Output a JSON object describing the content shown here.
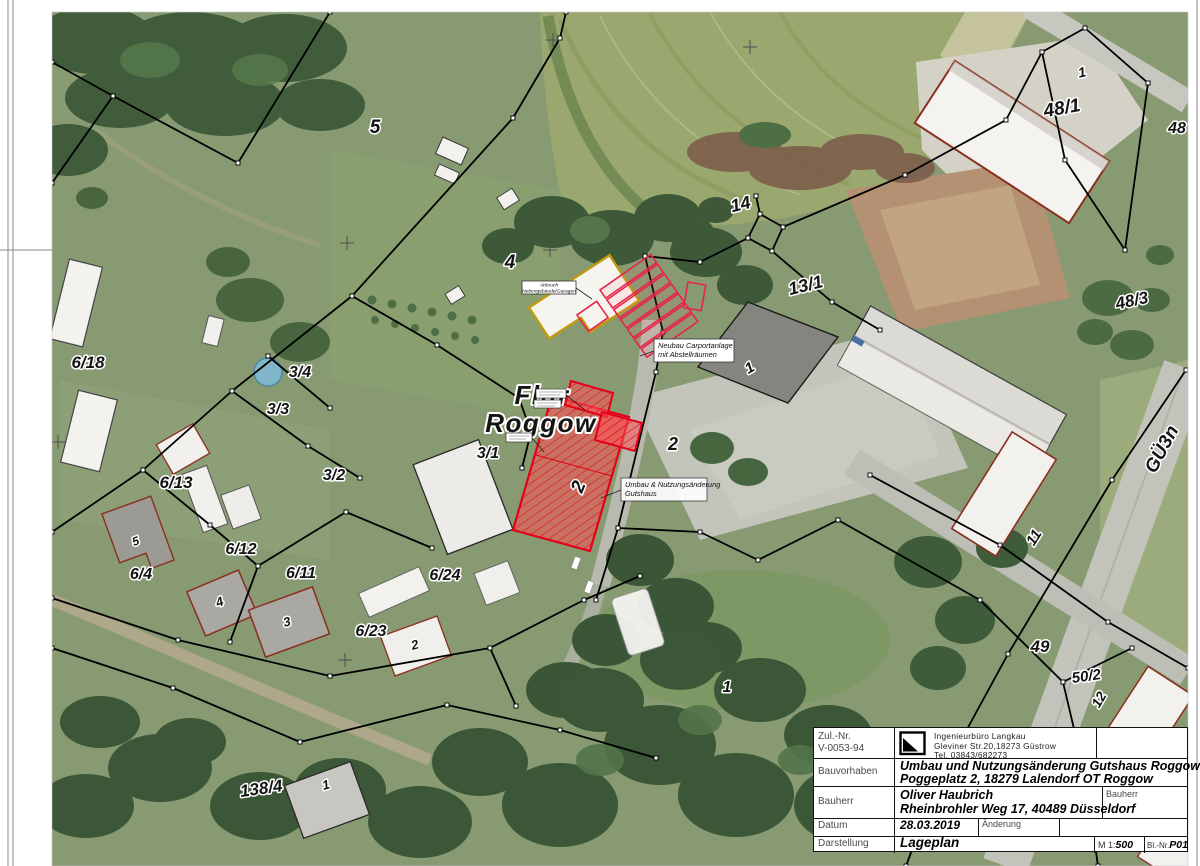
{
  "title_block": {
    "zul_label": "Zul.-Nr.",
    "zul_value": "V-0053-94",
    "company_name": "Ingenieurbüro Langkau",
    "company_street": "Gleviner Str.20,18273 Güstrow",
    "company_tel": "Tel. 03843/682273",
    "bauvorhaben_label": "Bauvorhaben",
    "bauvorhaben_line1": "Umbau und Nutzungsänderung Gutshaus Roggow",
    "bauvorhaben_line2": "Poggeplatz 2, 18279 Lalendorf OT Roggow",
    "bauherr_label": "Bauherr",
    "bauherr_line1": "Oliver Haubrich",
    "bauherr_line2": "Rheinbrohler Weg 17, 40489 Düsseldorf",
    "bauherr_right_label": "Bauherr",
    "datum_label": "Datum",
    "datum_value": "28.03.2019",
    "aenderung_label": "Änderung",
    "darstellung_label": "Darstellung",
    "darstellung_value": "Lageplan",
    "scale_prefix": "M  1:",
    "scale_value": "500",
    "blnr_label": "Bl.-Nr.",
    "blnr_value": "P01"
  },
  "map": {
    "flur_line1": "Flur",
    "flur_line2": "Roggow",
    "road_label": "GÜ3n",
    "annotations": {
      "abbruch_line1": "Abbruch",
      "abbruch_line2": "Nebengebäude/Garagen",
      "carport_line1": "Neubau Carportanlage",
      "carport_line2": "mit Abstellräumen",
      "umbau_line1": "Umbau & Nutzungsänderung",
      "umbau_line2": "Gutshaus"
    },
    "parcels": {
      "f5": "5",
      "f4": "4",
      "f1": "1",
      "p6_18": "6/18",
      "p3_4": "3/4",
      "p3_3": "3/3",
      "p3_2": "3/2",
      "p3_1": "3/1",
      "p6_13": "6/13",
      "p6_4": "6/4",
      "p6_12": "6/12",
      "p6_11": "6/11",
      "p6_23": "6/23",
      "p6_24": "6/24",
      "p138_4": "138/4",
      "p14": "14",
      "p13_1": "13/1",
      "p48_1": "48/1",
      "p48": "48",
      "p48_3": "48/3",
      "p49": "49",
      "p50_2": "50/2",
      "p2y": "2"
    },
    "buildings": {
      "tr1": "1",
      "h1": "1",
      "g2": "2",
      "b11": "11",
      "b12": "12",
      "b5": "5",
      "b4": "4",
      "b3": "3",
      "b2": "2",
      "b1": "1"
    }
  },
  "colors": {
    "project_red": "#e50019",
    "abbruch_yellow": "#c19a10",
    "cadastral_black": "#000000"
  }
}
